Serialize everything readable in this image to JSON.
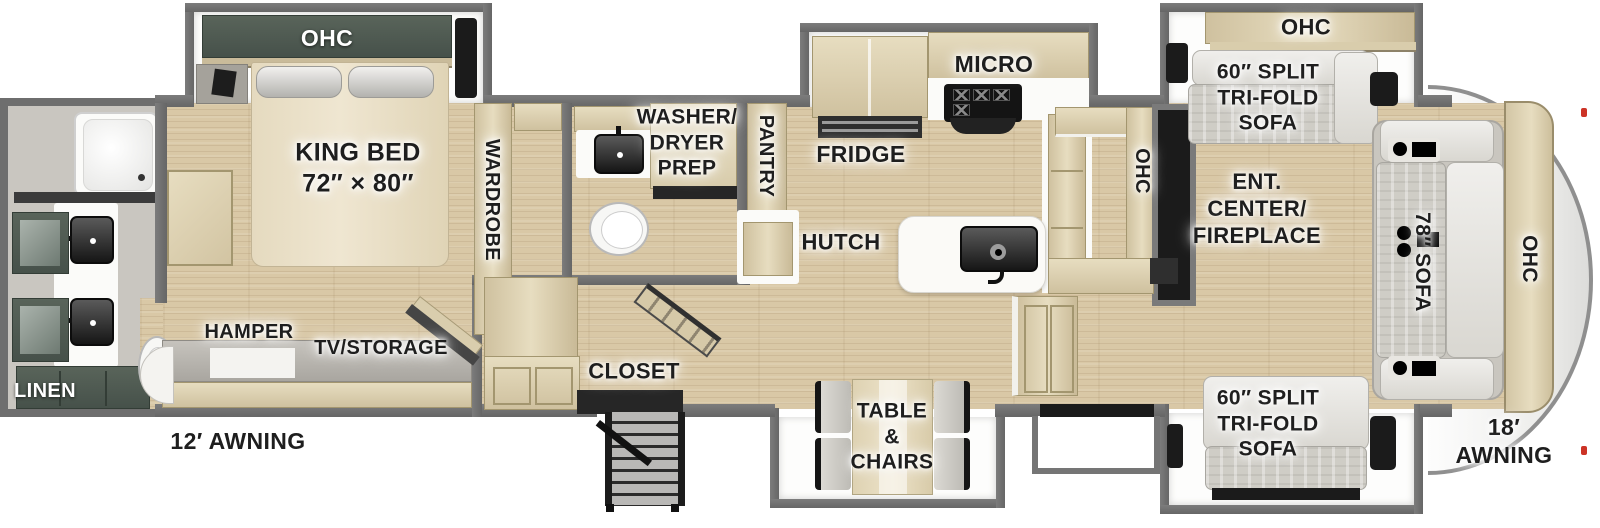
{
  "floorplan": {
    "bedroom": {
      "ohc": "OHC",
      "king_bed": "KING BED\n72″ × 80″",
      "wardrobe": "WARDROBE",
      "hamper": "HAMPER",
      "tv_storage": "TV/STORAGE"
    },
    "rear_bathroom": {
      "linen": "LINEN"
    },
    "mid_bathroom": {
      "washer_dryer_prep": "WASHER/\nDRYER\nPREP"
    },
    "kitchen": {
      "pantry": "PANTRY",
      "fridge": "FRIDGE",
      "micro": "MICRO",
      "hutch": "HUTCH",
      "ohc": "OHC"
    },
    "entry": {
      "closet": "CLOSET",
      "table_chairs": "TABLE\n&\nCHAIRS"
    },
    "living_room": {
      "ent_center": "ENT.\nCENTER/\nFIREPLACE",
      "ohc_top_slide": "OHC",
      "sofa_top": "60″ SPLIT\nTRI-FOLD\nSOFA",
      "sofa_bottom": "60″ SPLIT\nTRI-FOLD\nSOFA",
      "sofa_front": "78″ SOFA",
      "ohc_front": "OHC"
    },
    "exterior": {
      "awning_left": "12′ AWNING",
      "awning_right": "18′ AWNING"
    },
    "colors": {
      "wall_gray": "#6e6e6e",
      "floor_wood": "#d9c8a6",
      "cabinet_tan": "#ddd2b5",
      "cabinet_green": "#46514a",
      "label_dark": "#1e1e1e",
      "label_light": "#ffffff"
    }
  }
}
